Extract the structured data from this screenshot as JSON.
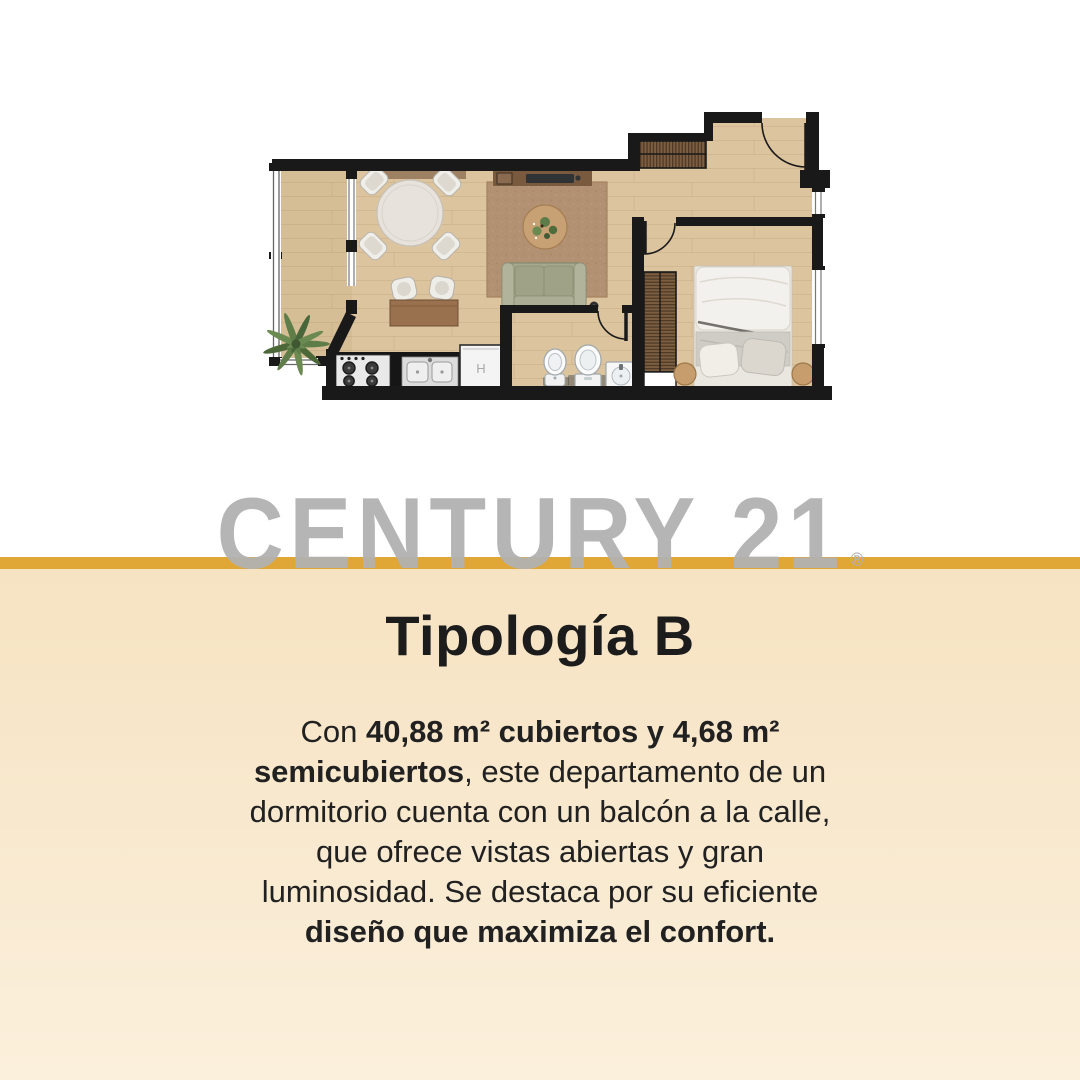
{
  "brand": {
    "watermark_text": "CENTURY 21",
    "registered_mark": "®"
  },
  "colors": {
    "divider_gold": "#E0A737",
    "background_top": "#FFFFFF",
    "background_bottom_start": "#F6E3C2",
    "background_bottom_end": "#FBF0DC",
    "watermark_gray": "#B1B1B1",
    "text_dark": "#1C1C1C",
    "wall_black": "#191919",
    "wood_floor": "#DCC49E",
    "rug_brown": "#B29173",
    "sofa_green": "#A6A98F"
  },
  "content": {
    "title": "Tipología B",
    "paragraph_lines": [
      {
        "runs": [
          {
            "text": "Con ",
            "bold": false
          },
          {
            "text": "40,88 m² cubiertos y 4,68 m²",
            "bold": true
          }
        ]
      },
      {
        "runs": [
          {
            "text": "semicubiertos",
            "bold": true
          },
          {
            "text": ", este departamento de un",
            "bold": false
          }
        ]
      },
      {
        "runs": [
          {
            "text": "dormitorio cuenta con un balcón a la calle,",
            "bold": false
          }
        ]
      },
      {
        "runs": [
          {
            "text": "que ofrece vistas abiertas y gran",
            "bold": false
          }
        ]
      },
      {
        "runs": [
          {
            "text": "luminosidad. Se destaca por su eficiente",
            "bold": false
          }
        ]
      },
      {
        "runs": [
          {
            "text": "diseño que maximiza el confort.",
            "bold": true
          }
        ]
      }
    ]
  },
  "floorplan": {
    "appliance_label": "H",
    "rooms": [
      "balcony",
      "living-dining",
      "kitchen",
      "bathroom",
      "bedroom",
      "entry-hall"
    ],
    "furniture": [
      "round-dining-table",
      "dining-chairs",
      "desk",
      "desk-chairs",
      "area-rug",
      "coffee-table-with-plant",
      "sofa",
      "tv-console",
      "floor-lamp",
      "kitchen-counter",
      "stove",
      "double-sink",
      "refrigerator",
      "bidet",
      "toilet",
      "bathroom-sink",
      "entry-wardrobe",
      "bedroom-closet",
      "double-bed",
      "pillows",
      "nightstands",
      "balcony-plant"
    ]
  }
}
